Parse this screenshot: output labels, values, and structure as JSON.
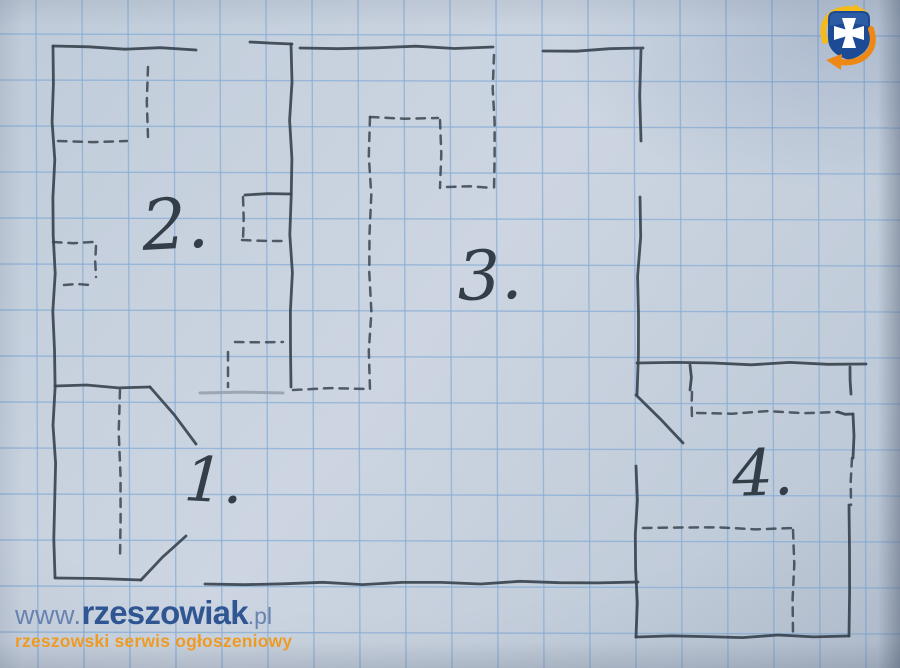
{
  "meta": {
    "description": "Photo of a hand-drawn apartment floor plan sketched in pencil on blue graph paper"
  },
  "paper": {
    "background": "#c7d1de",
    "grid_color": "#86add5",
    "grid_cell_px": 46,
    "grid_offset_x": 36,
    "grid_offset_y": 34,
    "pencil_color": "#3a444f",
    "light_pencil_color": "#949dab"
  },
  "plan": {
    "room_labels": [
      {
        "text": "1.",
        "x": 183,
        "y": 500,
        "size": 62,
        "rotate": 3
      },
      {
        "text": "2.",
        "x": 143,
        "y": 250,
        "size": 70,
        "rotate": -3
      },
      {
        "text": "3.",
        "x": 458,
        "y": 300,
        "size": 68,
        "rotate": -2
      },
      {
        "text": "4.",
        "x": 733,
        "y": 496,
        "size": 64,
        "rotate": -2
      }
    ],
    "solid_walls": [
      [
        53,
        46,
        196,
        50
      ],
      [
        250,
        42,
        292,
        44
      ],
      [
        291,
        44,
        291,
        387
      ],
      [
        300,
        48,
        493,
        47
      ],
      [
        543,
        51,
        643,
        48
      ],
      [
        641,
        50,
        641,
        141
      ],
      [
        640,
        197,
        637,
        395
      ],
      [
        53,
        46,
        55,
        577
      ],
      [
        55,
        386,
        150,
        387
      ],
      [
        150,
        387,
        196,
        444
      ],
      [
        186,
        536,
        141,
        580
      ],
      [
        55,
        578,
        141,
        580
      ],
      [
        205,
        584,
        638,
        582
      ],
      [
        636,
        466,
        636,
        637
      ],
      [
        636,
        637,
        849,
        636
      ],
      [
        849,
        505,
        849,
        636
      ],
      [
        637,
        363,
        866,
        364
      ],
      [
        636,
        395,
        683,
        443
      ],
      [
        690,
        365,
        690,
        390
      ],
      [
        850,
        367,
        851,
        394
      ],
      [
        838,
        412,
        853,
        414
      ],
      [
        853,
        414,
        853,
        458
      ],
      [
        245,
        195,
        291,
        194
      ]
    ],
    "dashed_walls": [
      [
        148,
        67,
        148,
        137
      ],
      [
        58,
        141,
        127,
        141
      ],
      [
        243,
        197,
        243,
        240
      ],
      [
        242,
        240,
        285,
        241
      ],
      [
        53,
        242,
        93,
        242
      ],
      [
        96,
        246,
        96,
        277
      ],
      [
        64,
        285,
        90,
        285
      ],
      [
        235,
        342,
        283,
        342
      ],
      [
        228,
        352,
        228,
        387
      ],
      [
        293,
        390,
        367,
        389
      ],
      [
        370,
        117,
        370,
        390
      ],
      [
        370,
        117,
        438,
        118
      ],
      [
        440,
        120,
        440,
        188
      ],
      [
        447,
        187,
        492,
        188
      ],
      [
        494,
        55,
        494,
        190
      ],
      [
        120,
        390,
        120,
        560
      ],
      [
        692,
        392,
        692,
        418
      ],
      [
        697,
        413,
        838,
        412
      ],
      [
        852,
        458,
        851,
        505
      ],
      [
        643,
        528,
        793,
        528
      ],
      [
        793,
        530,
        793,
        633
      ]
    ],
    "light_lines": [
      [
        200,
        393,
        283,
        393
      ]
    ]
  },
  "logo": {
    "name": "rzeszowiak-logo",
    "shield_color": "#1d4a94",
    "shield_highlight": "#3a6cb4",
    "cross_color": "#ffffff",
    "arrow_top_color": "#f4bb1a",
    "arrow_bottom_color": "#ee8814"
  },
  "watermark": {
    "url_prefix": "www.",
    "url_main": "rzeszowiak",
    "url_suffix": ".pl",
    "tagline": "rzeszowski serwis ogłoszeniowy",
    "colors": {
      "prefix": "#647fad",
      "main": "#27508f",
      "tagline": "#f0991b"
    }
  }
}
